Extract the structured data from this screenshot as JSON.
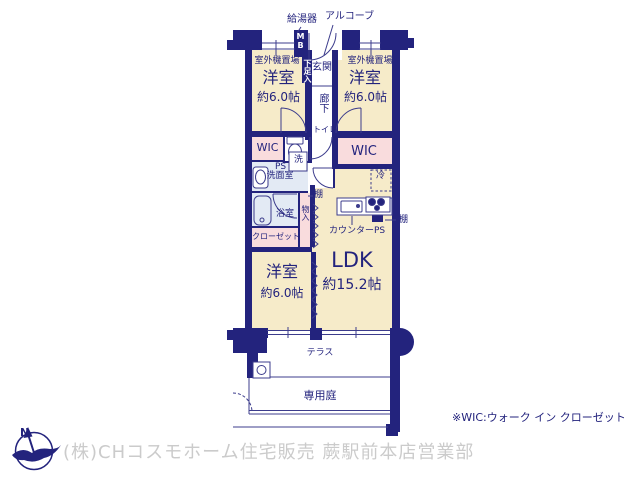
{
  "colors": {
    "wall_navy": "#23237d",
    "thin_line": "#3c3c8c",
    "text_navy": "#23237d",
    "room_cream": "#f6ebc9",
    "closet_pink": "#f9dcdd",
    "wet_area_blue": "#e3eaf4",
    "footer_gray": "#cbcbcb",
    "white": "#ffffff"
  },
  "plan": {
    "water_heater": "給湯器",
    "alcove": "アルコーブ",
    "meter_box": "MB",
    "shoe_cabinet": "下足入",
    "entrance": "玄関",
    "outdoor_unit_left": "室外機置場",
    "outdoor_unit_right": "室外機置場",
    "hallway": "廊下",
    "toilet": "トイレ",
    "wic_left": "WIC",
    "wic_right": "WIC",
    "pipe_space_1": "PS",
    "washer": "洗",
    "washroom": "洗面室",
    "bathroom": "浴室",
    "storage": "物入",
    "closet": "クローゼット",
    "shelf_left": "棚",
    "shelf_right": "棚",
    "fridge": "冷",
    "counter": "カウンター",
    "pipe_space_2": "PS",
    "bedroom1": {
      "name": "洋室",
      "size": "約6.0帖"
    },
    "bedroom2": {
      "name": "洋室",
      "size": "約6.0帖"
    },
    "bedroom3": {
      "name": "洋室",
      "size": "約6.0帖"
    },
    "ldk": {
      "name": "LDK",
      "size": "約15.2帖"
    },
    "terrace": "テラス",
    "garden": "専用庭"
  },
  "footnote": "※WIC:ウォーク イン クローゼット",
  "footer": {
    "compass_label": "N",
    "company": "(株)CHコスモホーム住宅販売 蕨駅前本店営業部"
  }
}
